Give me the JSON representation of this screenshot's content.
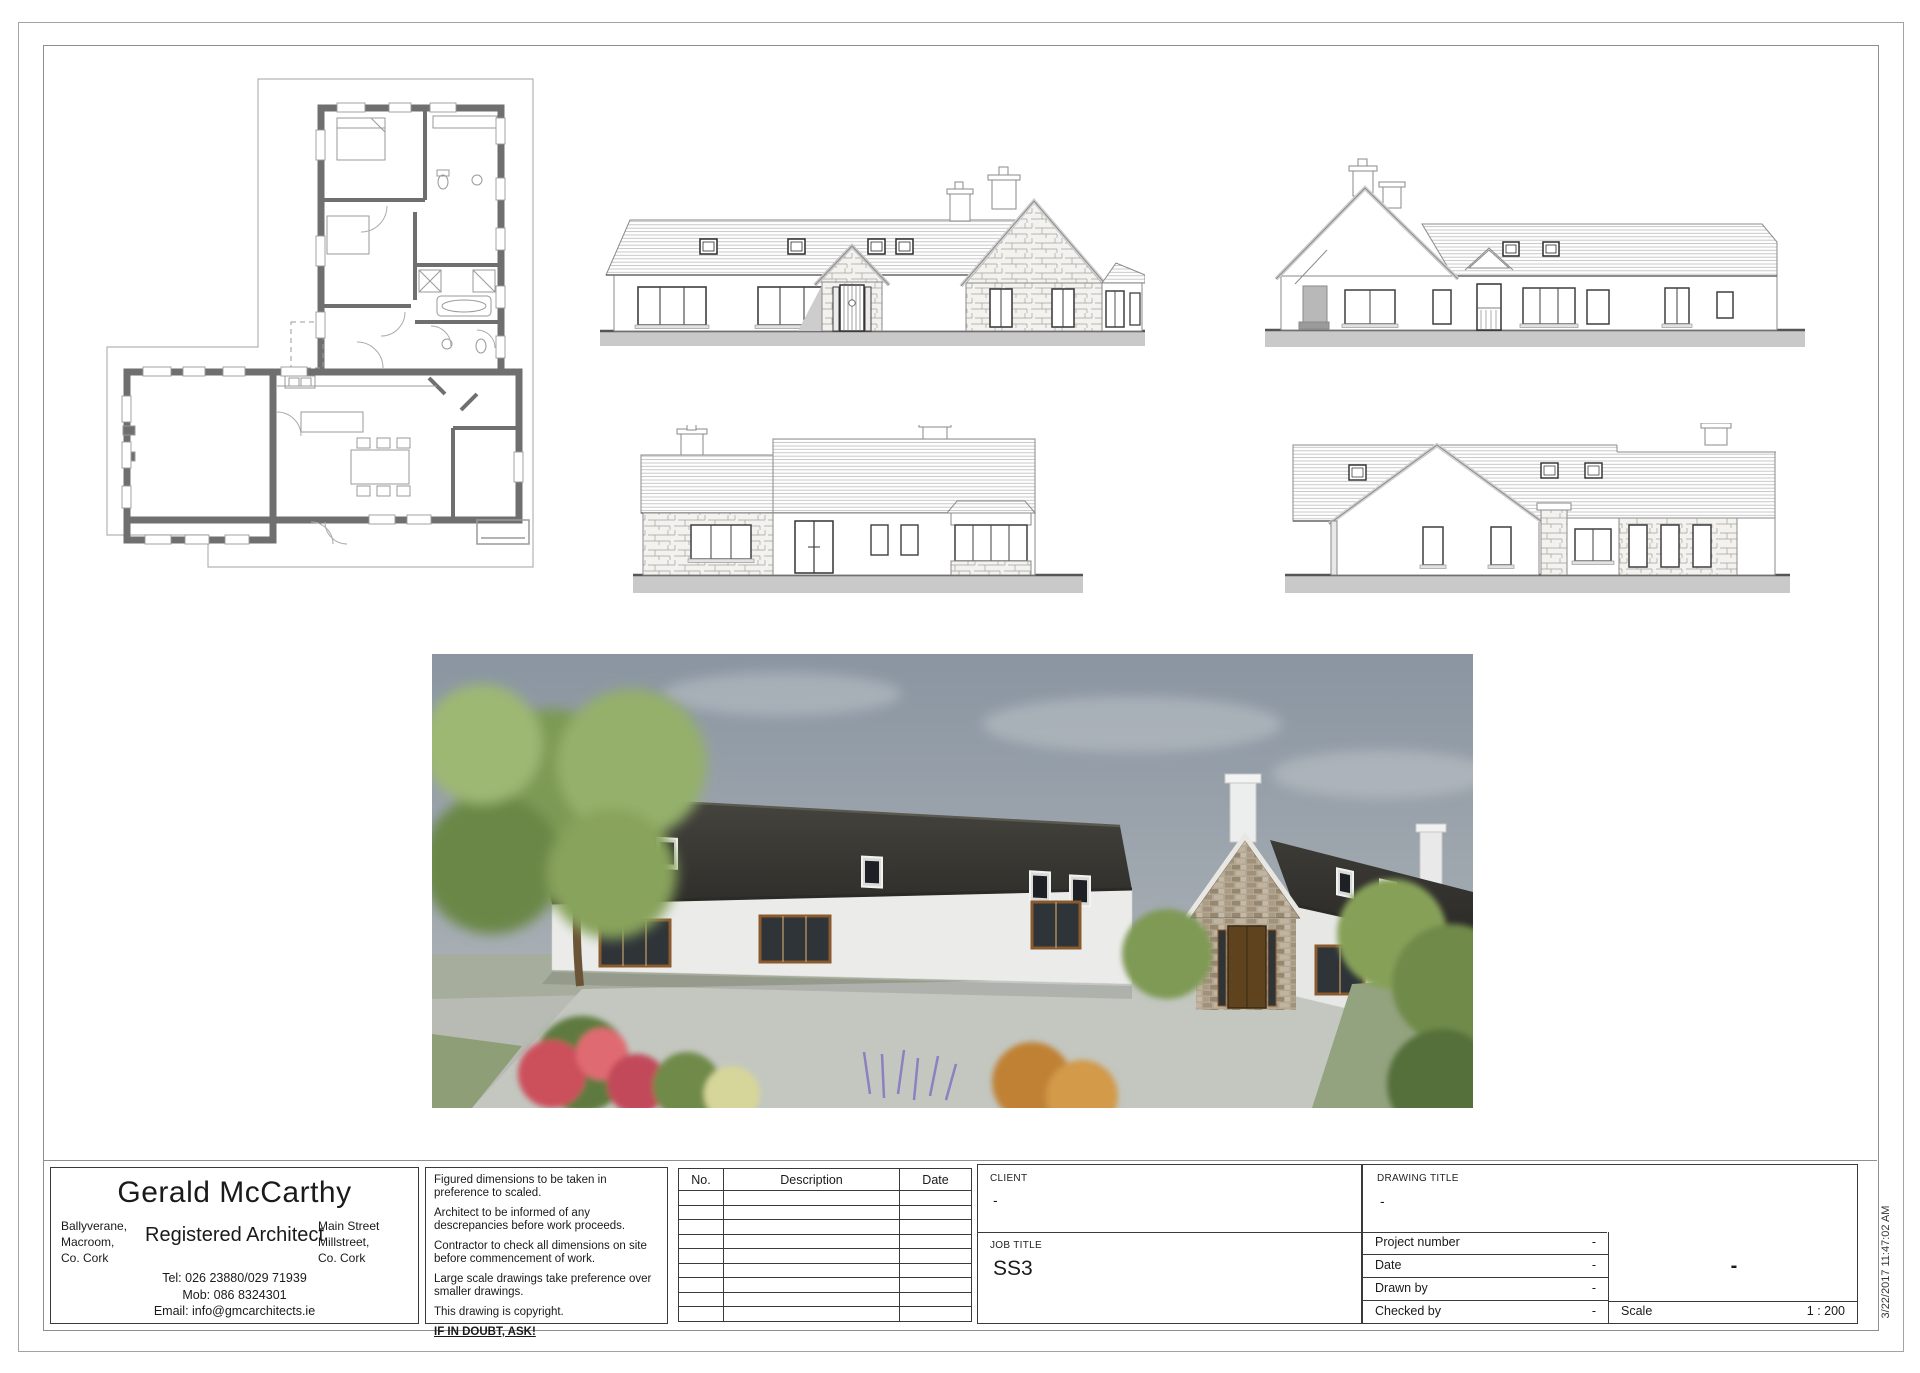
{
  "sheet": {
    "print_timestamp": "3/22/2017 11:47:02 AM"
  },
  "architect_panel": {
    "name": "Gerald McCarthy",
    "title": "Registered Architect",
    "address_left": [
      "Ballyverane,",
      "Macroom,",
      "Co. Cork"
    ],
    "address_right": [
      "Main Street",
      "Millstreet,",
      "Co. Cork"
    ],
    "contact": [
      "Tel: 026 23880/029 71939",
      "Mob: 086 8324301",
      "Email: info@gmcarchitects.ie"
    ]
  },
  "notes_panel": {
    "notes": [
      "Figured dimensions to be taken in preference to scaled.",
      "Architect to be informed of any descrepancies before work proceeds.",
      "Contractor to check all dimensions on site before commencement of work.",
      "Large scale drawings take preference over smaller drawings.",
      "This drawing is copyright."
    ],
    "emphasis": "IF IN DOUBT, ASK!"
  },
  "revision_table": {
    "headers": [
      "No.",
      "Description",
      "Date"
    ],
    "empty_row_count": 9
  },
  "title_block": {
    "client_label": "CLIENT",
    "client_value": "-",
    "job_title_label": "JOB TITLE",
    "job_title_value": "SS3",
    "drawing_title_label": "DRAWING TITLE",
    "drawing_title_value": "-",
    "fields": [
      {
        "label": "Project number",
        "value": "-"
      },
      {
        "label": "Date",
        "value": "-"
      },
      {
        "label": "Drawn by",
        "value": "-"
      },
      {
        "label": "Checked by",
        "value": "-"
      }
    ],
    "sheet_number": "-",
    "scale_label": "Scale",
    "scale_value": "1 : 200"
  }
}
